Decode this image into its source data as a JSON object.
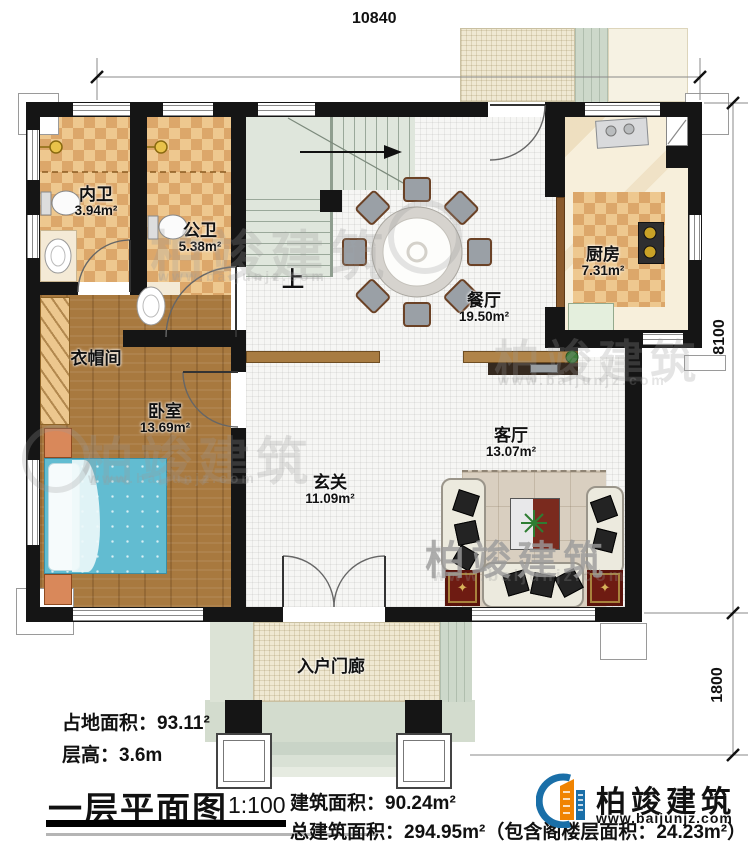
{
  "title": "一层平面图",
  "dimensions": {
    "top": "10840",
    "right_upper": "8100",
    "right_lower": "1800"
  },
  "rooms": {
    "neiwei": {
      "name": "内卫",
      "area": "3.94m²"
    },
    "gongwei": {
      "name": "公卫",
      "area": "5.38m²"
    },
    "kitchen": {
      "name": "厨房",
      "area": "7.31m²"
    },
    "dining": {
      "name": "餐厅",
      "area": "19.50m²"
    },
    "cloakroom": {
      "name": "衣帽间"
    },
    "bedroom": {
      "name": "卧室",
      "area": "13.69m²"
    },
    "living": {
      "name": "客厅",
      "area": "13.07m²"
    },
    "foyer": {
      "name": "玄关",
      "area": "11.09m²"
    },
    "porch": {
      "name": "入户门廊"
    }
  },
  "stairs": {
    "direction_label": "上"
  },
  "legend": {
    "land_area": "占地面积：93.11²",
    "floor_height": "层高：3.6m",
    "title": "一层平面图",
    "scale": "1:100",
    "building_area": "建筑面积：90.24m²",
    "total_area": "总建筑面积：294.95m²（包含阁楼层面积：24.23m²）"
  },
  "brand": {
    "name": "柏竣建筑",
    "website": "www.baijunjz.com"
  },
  "watermark": {
    "name": "柏竣建筑",
    "website": "www.baijunjz.com"
  },
  "colors": {
    "wall": "#151515",
    "tile": "#eec88f",
    "tile_alt": "#dca76a",
    "wood": "#a8793f",
    "stair": "#dfe6dc",
    "bed": "#62bcd1",
    "rug_red": "#6e1b12",
    "brand_blue": "#1a6fa8",
    "brand_orange": "#f08300"
  }
}
